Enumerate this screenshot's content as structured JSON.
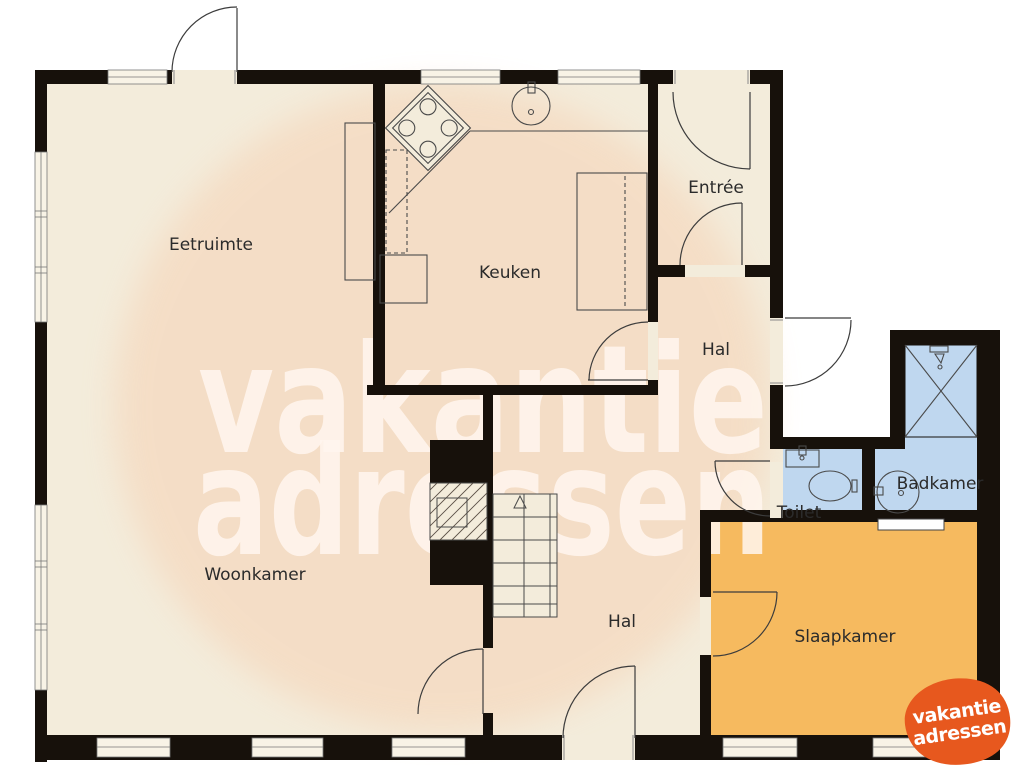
{
  "labels": {
    "eetruimte": "Eetruimte",
    "keuken": "Keuken",
    "entree": "Entrée",
    "hal_upper": "Hal",
    "hal_lower": "Hal",
    "woonkamer": "Woonkamer",
    "toilet": "Toilet",
    "badkamer": "Badkamer",
    "slaapkamer": "Slaapkamer"
  },
  "watermark": {
    "line1": "vakantie",
    "line2": "adressen"
  },
  "logo": {
    "line1": "vakantie",
    "line2": "adressen"
  },
  "colors": {
    "floor_cream": "#f3ecdb",
    "wall_black": "#17110b",
    "bedroom_orange": "#f6ba5f",
    "bathroom_blue": "#bfd7ef",
    "watermark_peach": "#f8c7a5",
    "logo_orange": "#e7581e",
    "label_text": "#2b2b2b"
  }
}
